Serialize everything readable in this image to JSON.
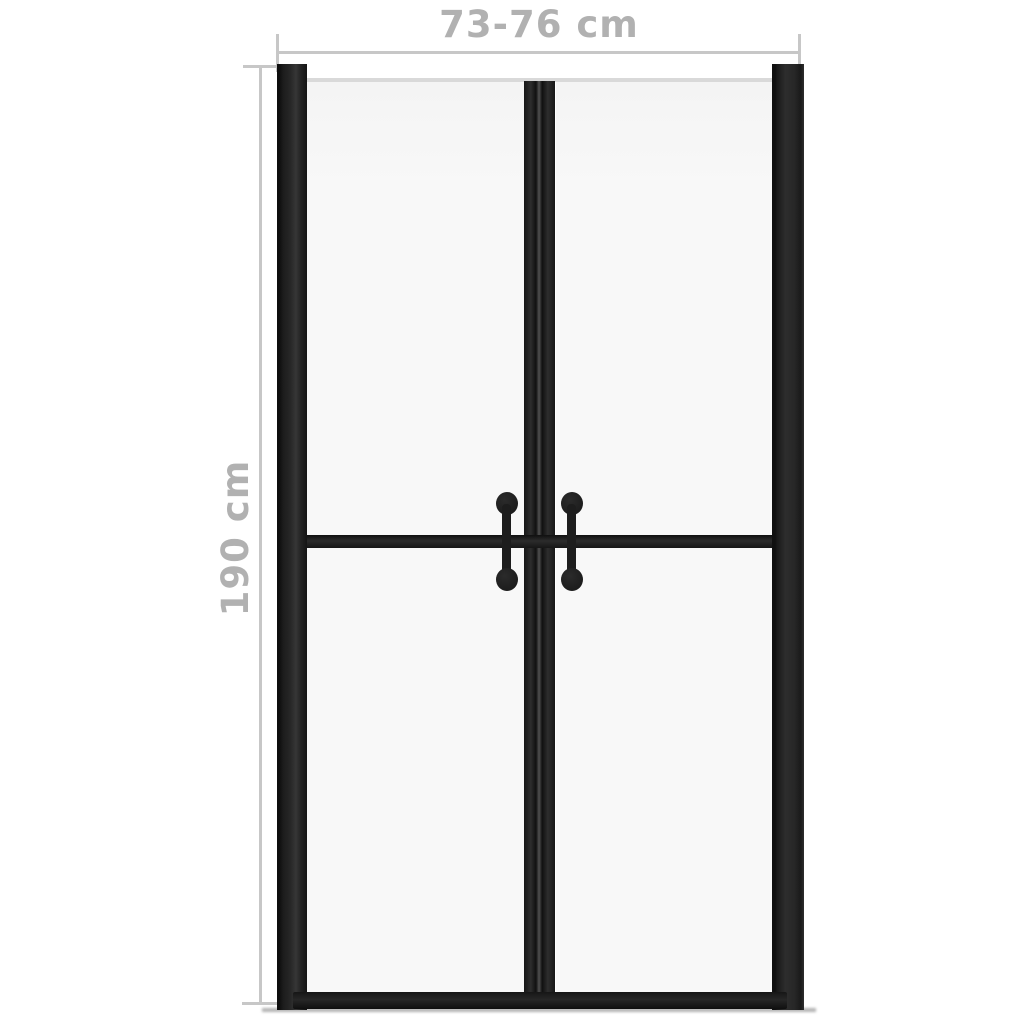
{
  "diagram": {
    "width_dimension": {
      "label": "73-76 cm"
    },
    "height_dimension": {
      "label": "190 cm"
    },
    "colors": {
      "background": "#ffffff",
      "frame": "#1d1d1d",
      "glass": "#f8f8f8",
      "glass-edge": "#d9d9d9",
      "dimension-line": "#c7c7c7",
      "dimension-text": "#b1b1b1",
      "shadow": "#b4b4b4"
    }
  }
}
